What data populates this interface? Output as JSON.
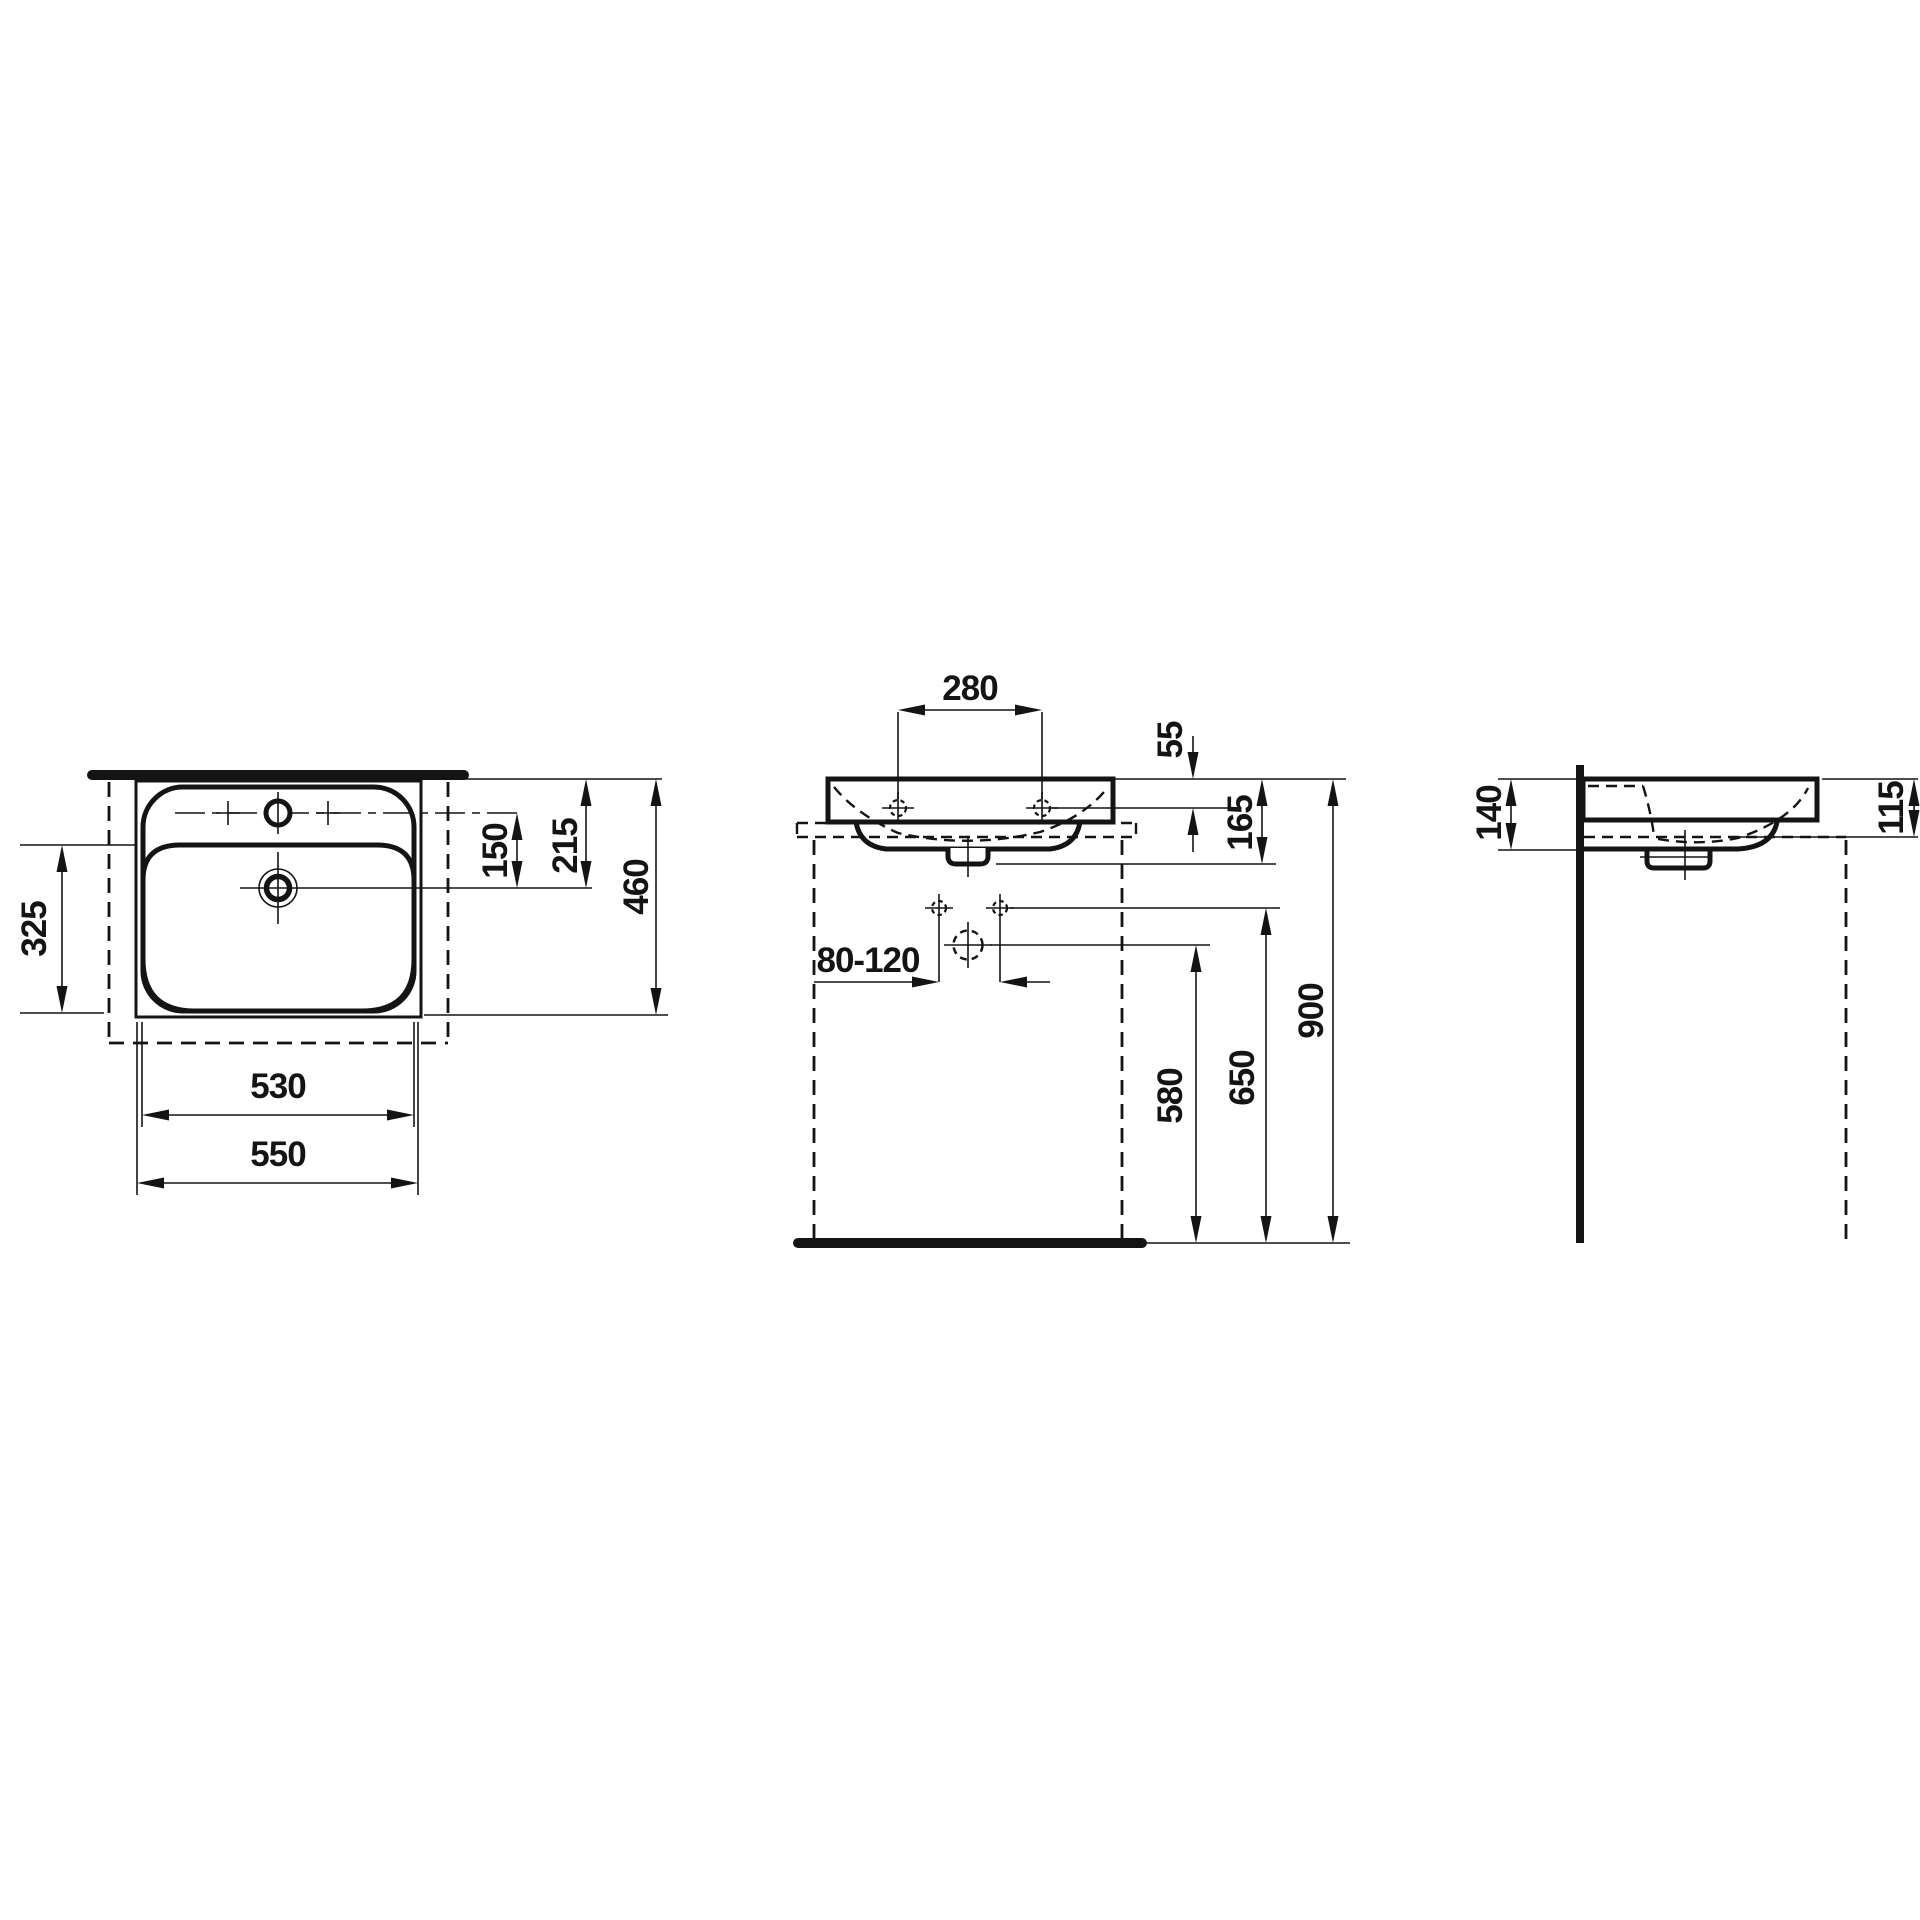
{
  "colors": {
    "line": "#141414",
    "background": "#ffffff"
  },
  "views": {
    "top": {
      "dims": {
        "overall_width": "550",
        "bowl_width": "530",
        "bowl_depth": "325",
        "tap_to_drain": "150",
        "front_edge_to_drain": "215",
        "overall_depth": "460"
      }
    },
    "front": {
      "dims": {
        "tap_hole_spacing": "280",
        "top_to_face_holes": "55",
        "top_to_trap_bottom": "165",
        "fixing_bolt_spacing": "80-120",
        "drain_outlet_height": "580",
        "fixing_bolt_height": "650",
        "rim_height": "900"
      }
    },
    "side": {
      "dims": {
        "rear_ledge_depth": "140",
        "top_to_bracket": "115"
      }
    }
  }
}
